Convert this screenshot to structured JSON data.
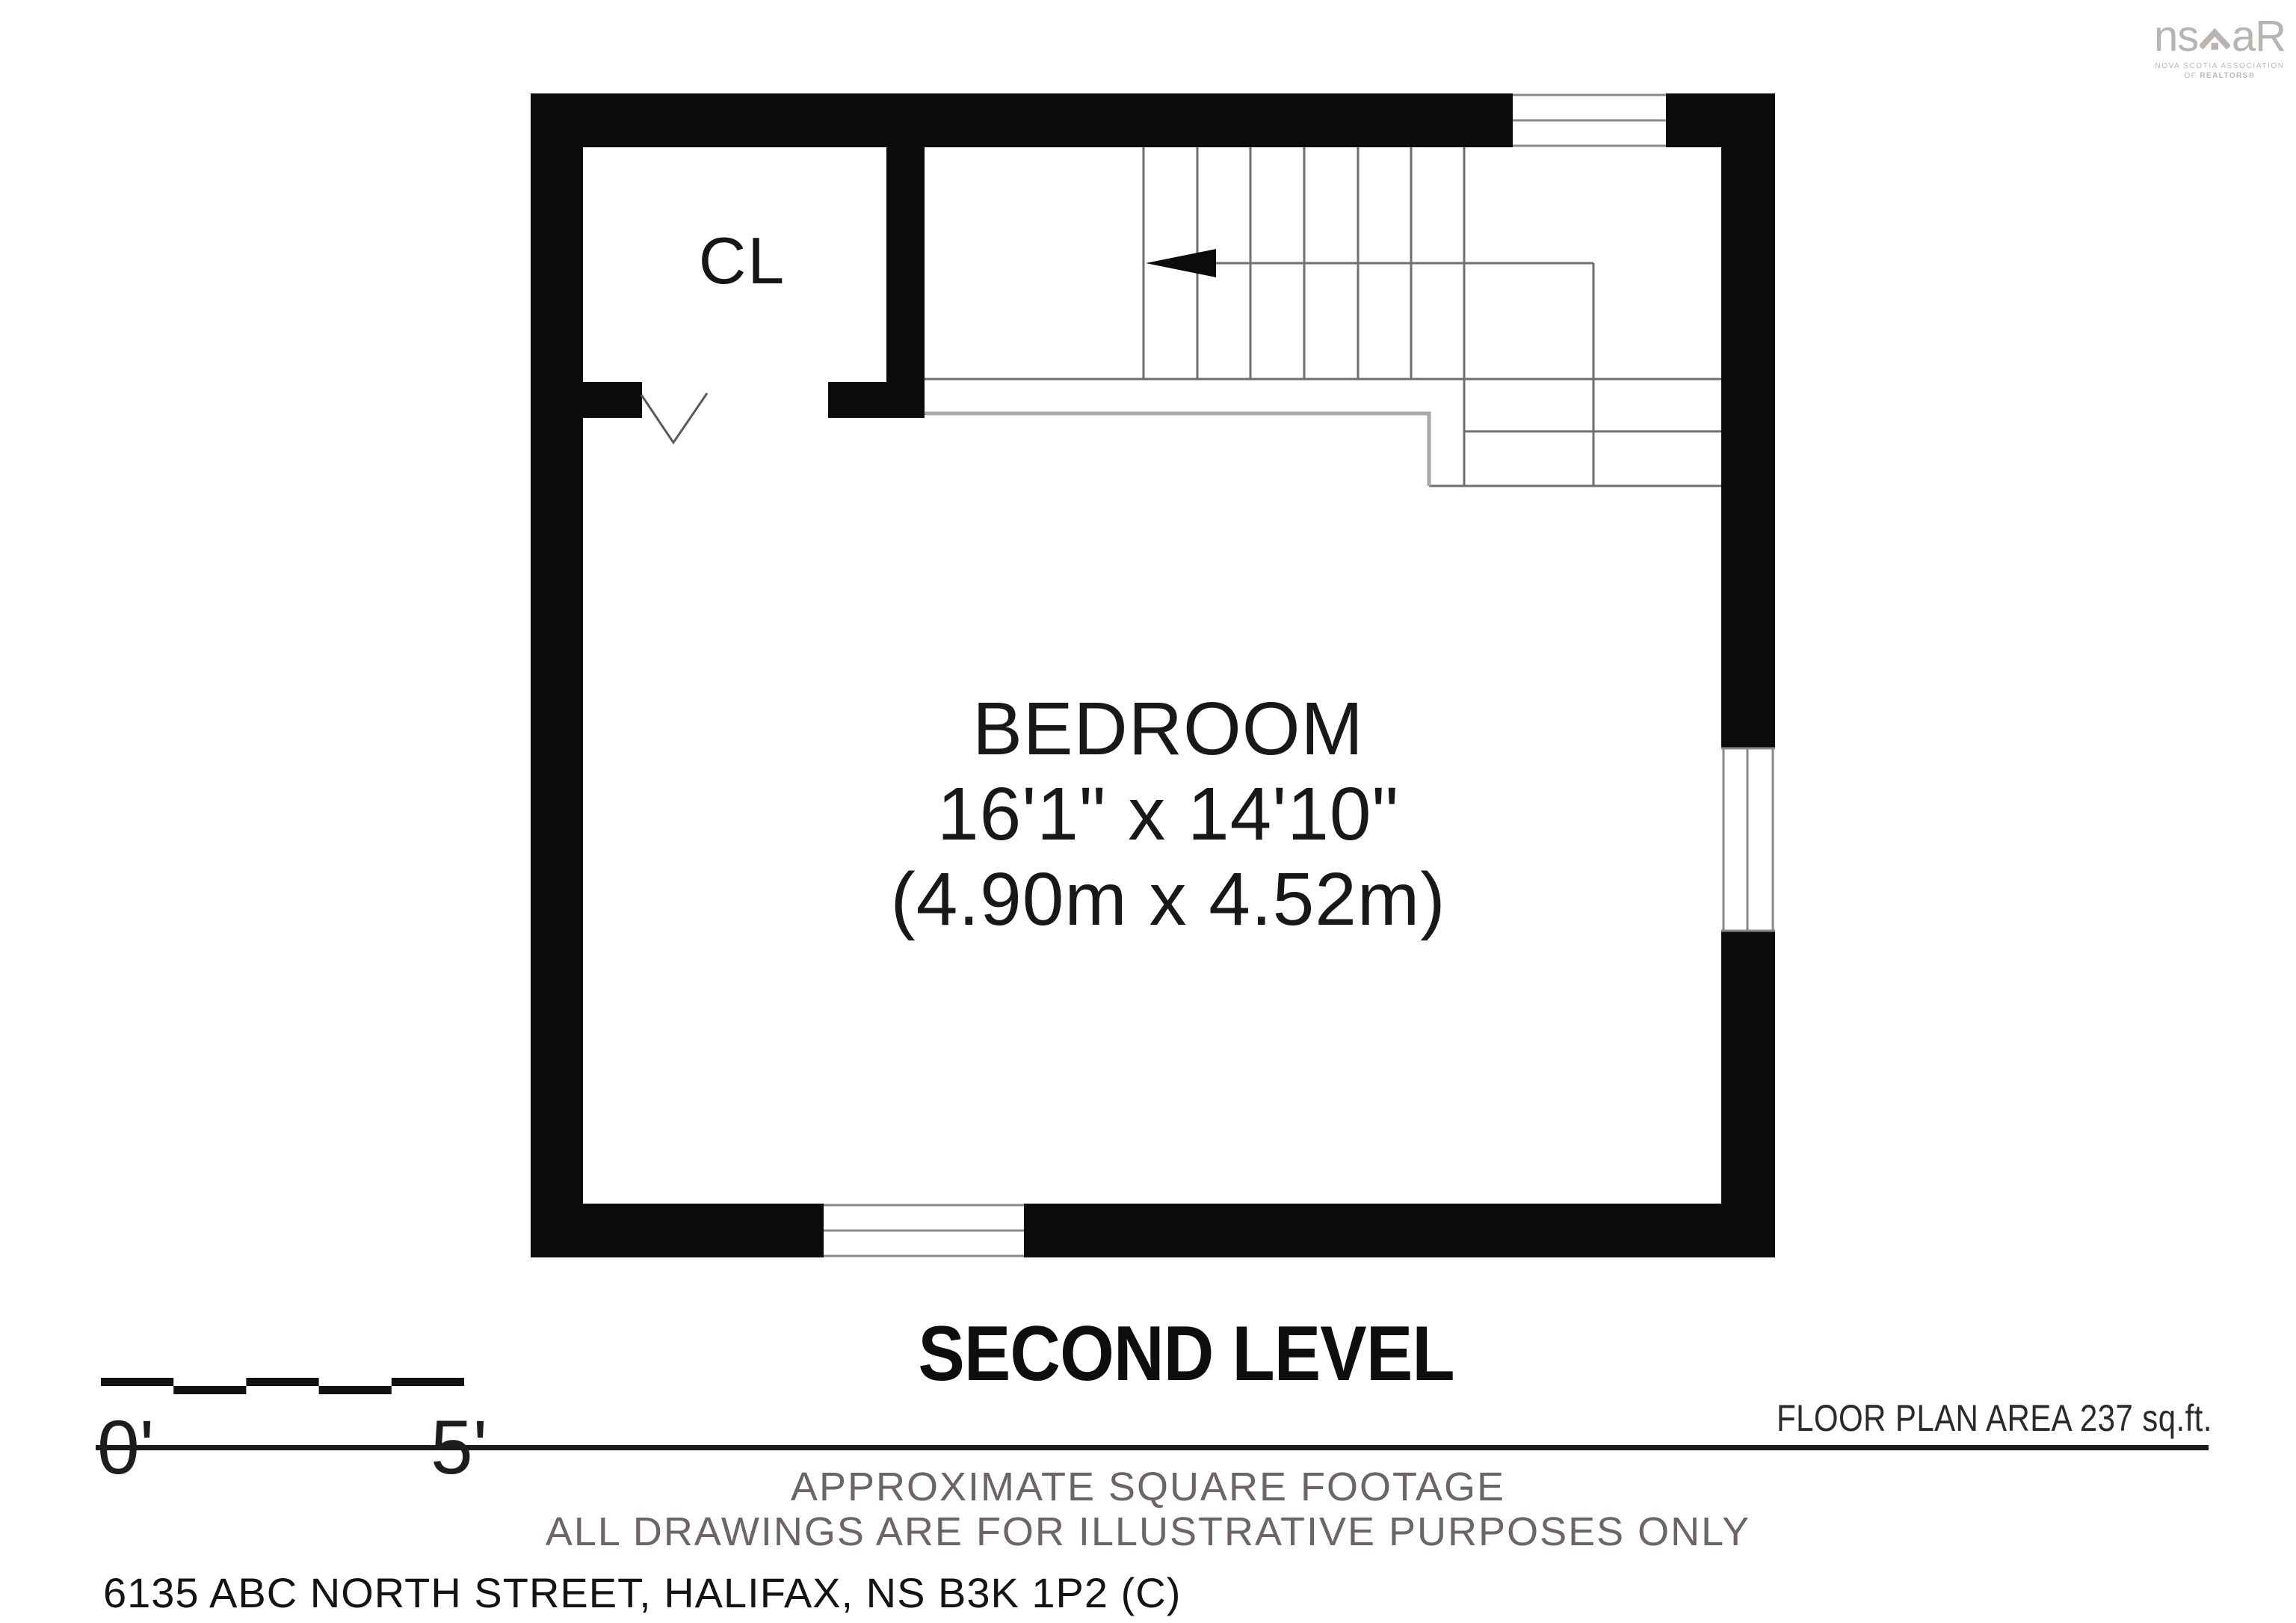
{
  "logo": {
    "brand_left": "ns",
    "brand_right": "aR",
    "line1": "NOVA SCOTIA ASSOCIATION",
    "line2_prefix": "OF ",
    "line2_bold": "REALTORS®"
  },
  "plan": {
    "closet_label": "CL",
    "room": {
      "name": "BEDROOM",
      "imperial": "16'1\" x 14'10\"",
      "metric": "(4.90m x 4.52m)"
    }
  },
  "title": "SECOND LEVEL",
  "scale_bar": {
    "start_label": "0'",
    "end_label": "5'"
  },
  "area_note": "FLOOR PLAN AREA 237 sq.ft.",
  "footer": {
    "line1": "APPROXIMATE SQUARE FOOTAGE",
    "line2": "ALL DRAWINGS ARE FOR ILLUSTRATIVE PURPOSES ONLY",
    "address": "6135 ABC NORTH STREET, HALIFAX, NS B3K 1P2 (C)"
  },
  "colors": {
    "wall": "#0b0b0b",
    "hairline": "#6f6f6f",
    "step_line": "#a8a8a8",
    "muted_text": "#6c6563",
    "logo_gray": "#b7b4b2"
  }
}
